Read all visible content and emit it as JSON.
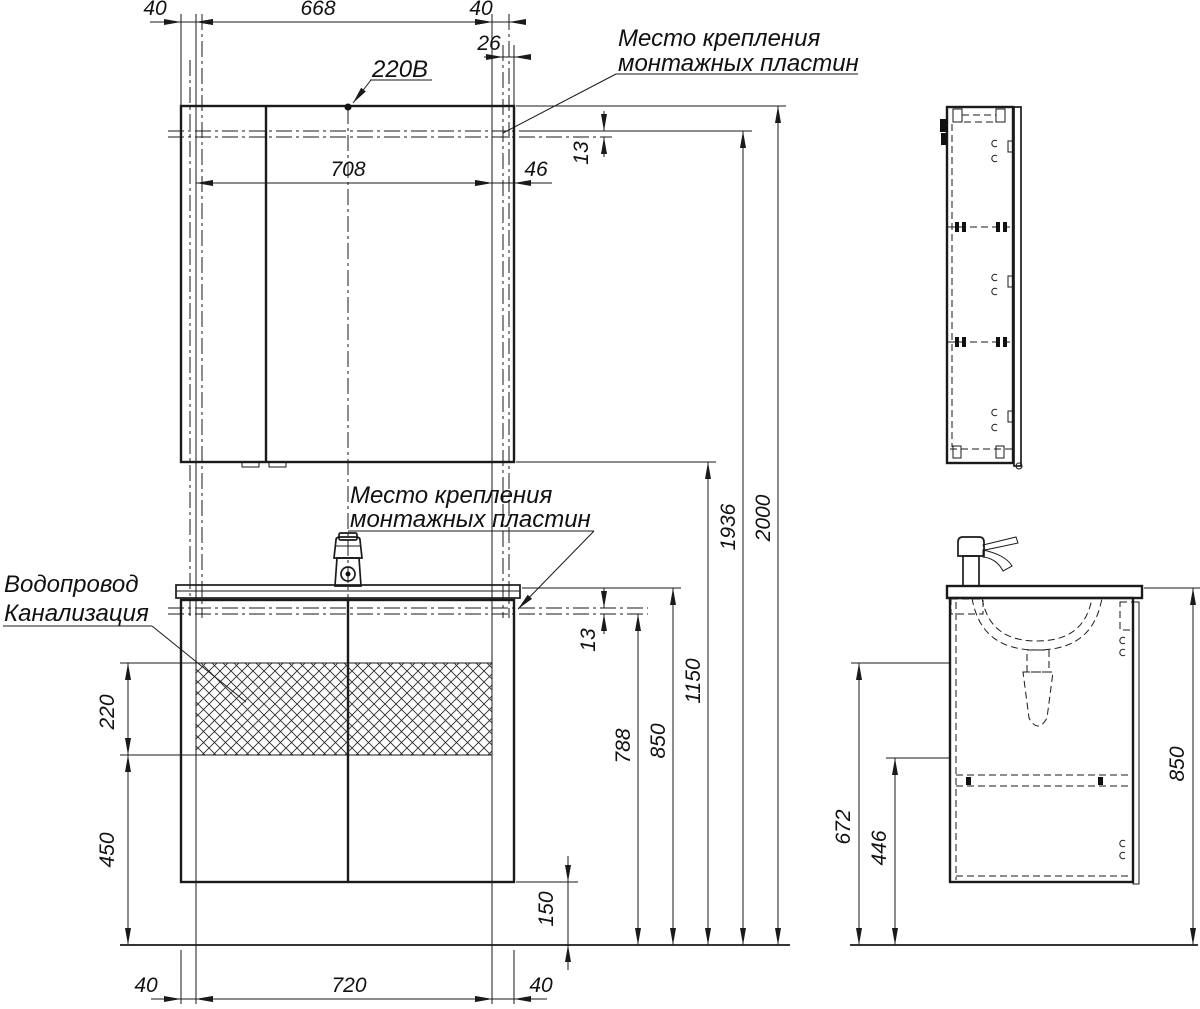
{
  "drawing": {
    "labels": {
      "power_supply": "220В",
      "mounting_plates_top": {
        "line1": "Место крепления",
        "line2": "монтажных пластин"
      },
      "mounting_plates_middle": {
        "line1": "Место крепления",
        "line2": "монтажных пластин"
      },
      "water_supply": "Водопровод",
      "sewerage": "Канализация"
    },
    "dimensions_mm": {
      "mirror_top": {
        "left_margin": "40",
        "mount_span": "668",
        "right_margin": "40",
        "plate_offset": "26",
        "inner_span": "708",
        "edge_gap": "46",
        "plate_height": "13"
      },
      "heights": {
        "total": "2000",
        "mirror_mount_level": "1936",
        "mirror_bottom_level": "1150",
        "washbasin_top_level": "850",
        "vanity_mount_level": "788",
        "vanity_plate_height": "13"
      },
      "service_zone": {
        "zone_height": "220",
        "zone_to_floor": "450"
      },
      "vanity_bottom": {
        "left_margin": "40",
        "mount_span": "720",
        "right_margin": "40",
        "floor_clearance": "150"
      },
      "side_view": {
        "basin_underside_level": "672",
        "drawer_level": "446",
        "washbasin_height": "850"
      }
    }
  }
}
